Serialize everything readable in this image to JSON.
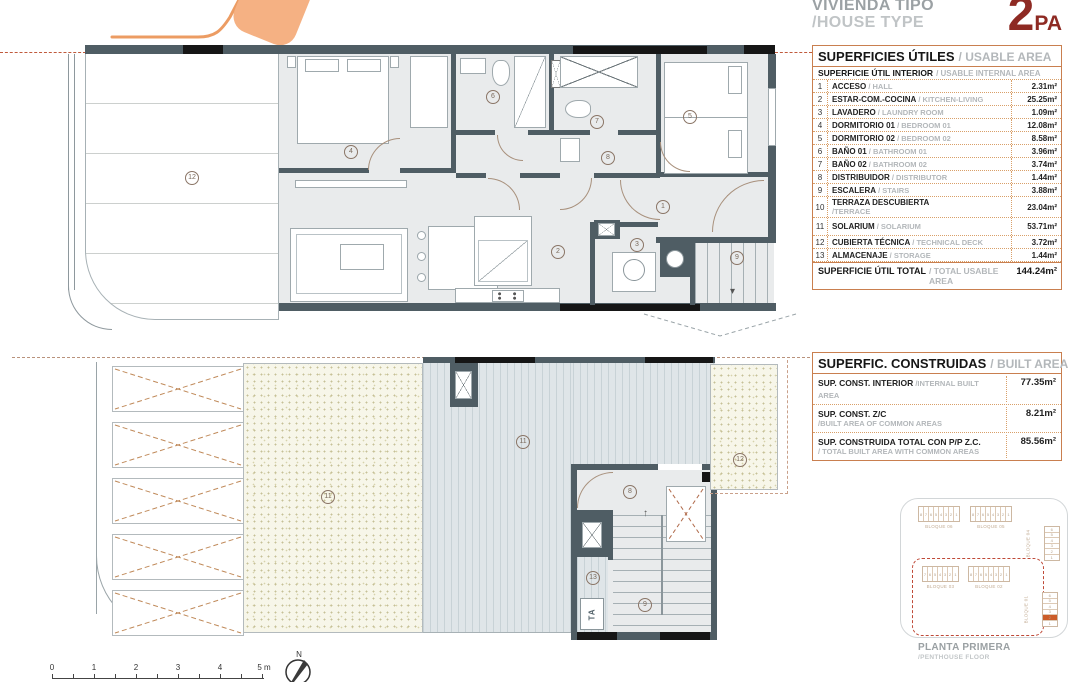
{
  "header": {
    "project_title": "VIVIENDA TIPO",
    "project_subtitle": "/HOUSE TYPE",
    "type_number": "2",
    "type_suffix": "PA"
  },
  "usable_table": {
    "title_es": "SUPERFICIES ÚTILES",
    "title_en": "/ USABLE AREA",
    "subheader_es": "SUPERFICIE ÚTIL INTERIOR",
    "subheader_en": "/ USABLE INTERNAL AREA",
    "rows": [
      {
        "num": "1",
        "name_es": "ACCESO",
        "name_en": "/ HALL",
        "value": "2.31m²"
      },
      {
        "num": "2",
        "name_es": "ESTAR-COM.-COCINA",
        "name_en": "/ KITCHEN-LIVING",
        "value": "25.25m²"
      },
      {
        "num": "3",
        "name_es": "LAVADERO",
        "name_en": "/ LAUNDRY ROOM",
        "value": "1.09m²"
      },
      {
        "num": "4",
        "name_es": "DORMITORIO 01",
        "name_en": "/ BEDROOM 01",
        "value": "12.08m²"
      },
      {
        "num": "5",
        "name_es": "DORMITORIO 02",
        "name_en": "/ BEDROOM 02",
        "value": "8.58m²"
      },
      {
        "num": "6",
        "name_es": "BAÑO 01",
        "name_en": "/ BATHROOM 01",
        "value": "3.96m²"
      },
      {
        "num": "7",
        "name_es": "BAÑO 02",
        "name_en": "/ BATHROOM 02",
        "value": "3.74m²"
      },
      {
        "num": "8",
        "name_es": "DISTRIBUIDOR",
        "name_en": "/ DISTRIBUTOR",
        "value": "1.44m²"
      },
      {
        "num": "9",
        "name_es": "ESCALERA",
        "name_en": "/ STAIRS",
        "value": "3.88m²"
      },
      {
        "num": "10",
        "name_es": "TERRAZA DESCUBIERTA",
        "name_en": "/TERRACE",
        "value": "23.04m²",
        "stacked": true
      },
      {
        "num": "11",
        "name_es": "SOLARIUM",
        "name_en": "/ SOLARIUM",
        "value": "53.71m²",
        "gap_before": true
      },
      {
        "num": "12",
        "name_es": "CUBIERTA TÉCNICA",
        "name_en": "/ TECHNICAL DECK",
        "value": "3.72m²"
      },
      {
        "num": "13",
        "name_es": "ALMACENAJE",
        "name_en": "/ STORAGE",
        "value": "1.44m²"
      }
    ],
    "total_label_es": "SUPERFICIE ÚTIL TOTAL",
    "total_label_en": "/ TOTAL USABLE AREA",
    "total_value": "144.24m²"
  },
  "built_table": {
    "title_es": "SUPERFIC. CONSTRUIDAS",
    "title_en": "/ BUILT AREA",
    "rows": [
      {
        "label_es": "SUP. CONST. INTERIOR",
        "label_en": "/INTERNAL BUILT AREA",
        "value": "77.35m²",
        "two_line": false
      },
      {
        "label_es": "SUP. CONST. Z/C",
        "label_en": "/BUILT AREA OF COMMON AREAS",
        "value": "8.21m²",
        "two_line": true
      },
      {
        "label_es": "SUP. CONSTRUIDA TOTAL CON P/P Z.C.",
        "label_en": "/ TOTAL BUILT AREA WITH COMMON AREAS",
        "value": "85.56m²",
        "two_line": true
      }
    ]
  },
  "key_plan": {
    "caption_title": "PLANTA PRIMERA",
    "caption_subtitle": "/PENTHOUSE FLOOR",
    "blocks": [
      {
        "label": "BLOQUE 06",
        "units": [
          "8",
          "7",
          "6",
          "5",
          "4",
          "3",
          "2",
          "1"
        ]
      },
      {
        "label": "BLOQUE 05",
        "units": [
          "8",
          "7",
          "6",
          "5",
          "4",
          "3",
          "2",
          "1"
        ]
      },
      {
        "label": "BLOQUE 04",
        "units": [
          "6",
          "5",
          "4",
          "3",
          "2",
          "1"
        ],
        "vertical": true
      },
      {
        "label": "BLOQUE 03",
        "units": [
          "7",
          "6",
          "5",
          "4",
          "3",
          "2",
          "1"
        ]
      },
      {
        "label": "BLOQUE 02",
        "units": [
          "8",
          "7",
          "6",
          "5",
          "4",
          "3",
          "2",
          "1"
        ]
      },
      {
        "label": "BLOQUE 01",
        "units": [
          "6",
          "5",
          "4",
          "3",
          "2",
          "1"
        ],
        "vertical": true,
        "highlight_index": 4
      }
    ]
  },
  "plans": {
    "upper": {
      "markers": [
        "12",
        "4",
        "6",
        "7",
        "5",
        "1",
        "2",
        "3",
        "8",
        "9"
      ]
    },
    "lower": {
      "markers": [
        "11",
        "11",
        "8",
        "13",
        "9",
        "12"
      ],
      "ta_label": "TA"
    }
  },
  "scale_bar": {
    "labels": [
      "0",
      "1",
      "2",
      "3",
      "4",
      "5 m"
    ],
    "north_label": "N"
  },
  "colors": {
    "accent_orange": "#f5b183",
    "type_red": "#8e2a23",
    "table_border": "#c97f4f",
    "muted_text": "#b3b7ba",
    "wall": "#4f5d64",
    "highlight_unit": "#cc5c28",
    "dashed_outline": "#bf4a38"
  }
}
